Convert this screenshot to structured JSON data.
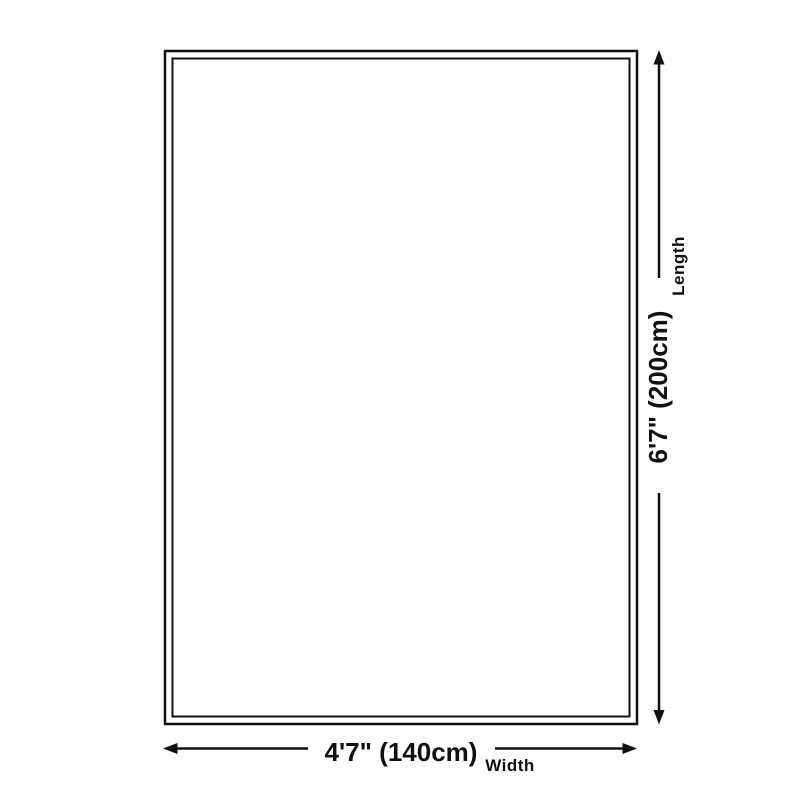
{
  "diagram": {
    "kind": "product-size-diagram",
    "shape": "rectangle",
    "length": {
      "value": "6'7\" (200cm)",
      "label": "Length",
      "arrow_icons": [
        "arrow-up-icon",
        "arrow-down-icon"
      ]
    },
    "width": {
      "value": "4'7\" (140cm)",
      "label": "Width",
      "arrow_icons": [
        "arrow-left-icon",
        "arrow-right-icon"
      ]
    },
    "colors": {
      "line": "#111111",
      "background": "#ffffff"
    }
  }
}
